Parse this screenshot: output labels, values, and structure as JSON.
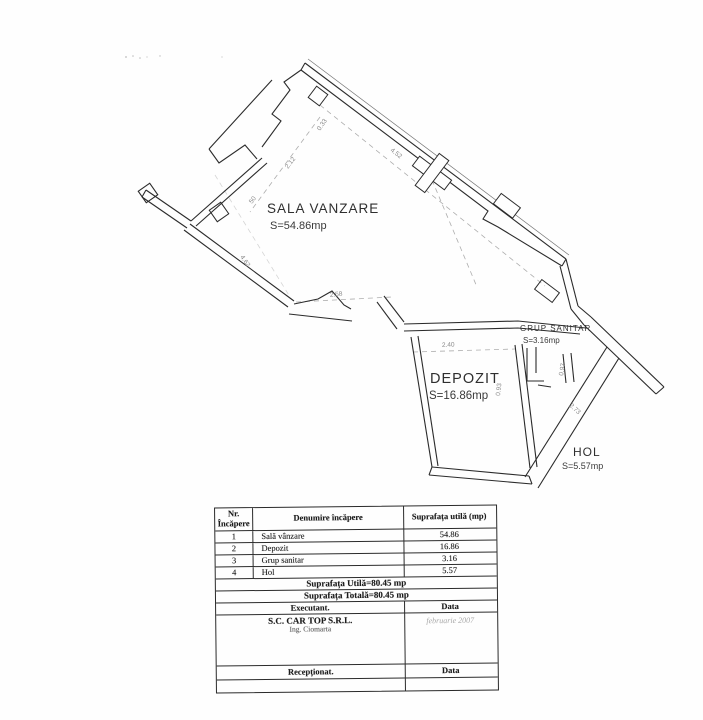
{
  "plan": {
    "rooms": [
      {
        "name": "SALA VANZARE",
        "area": "S=54.86mp"
      },
      {
        "name": "DEPOZIT",
        "area": "S=16.86mp"
      },
      {
        "name": "GRUP SANITAR",
        "area": "S=3.16mp"
      },
      {
        "name": "HOL",
        "area": "S=5.57mp"
      }
    ],
    "dims": [
      "0.33",
      "4.52",
      "2.12",
      "50",
      "4.62",
      "2.58",
      "2.40",
      "0.93",
      "0.97",
      "2.73"
    ]
  },
  "table": {
    "header": {
      "col1_line1": "Nr.",
      "col1_line2": "Încăpere",
      "col2": "Denumire încăpere",
      "col3": "Suprafața utilă (mp)"
    },
    "rows": [
      {
        "nr": "1",
        "name": "Sală vânzare",
        "area": "54.86"
      },
      {
        "nr": "2",
        "name": "Depozit",
        "area": "16.86"
      },
      {
        "nr": "3",
        "name": "Grup sanitar",
        "area": "3.16"
      },
      {
        "nr": "4",
        "name": "Hol",
        "area": "5.57"
      }
    ],
    "total_utila": "Suprafața Utilă=80.45 mp",
    "total_totala": "Suprafața Totală=80.45 mp",
    "executant_label": "Executant.",
    "data_label": "Data",
    "executant_company": "S.C. CAR TOP S.R.L.",
    "executant_engineer": "Ing. Ciomarta",
    "date_value": "februarie 2007",
    "receptionat_label": "Recepționat.",
    "data_label2": "Data"
  }
}
